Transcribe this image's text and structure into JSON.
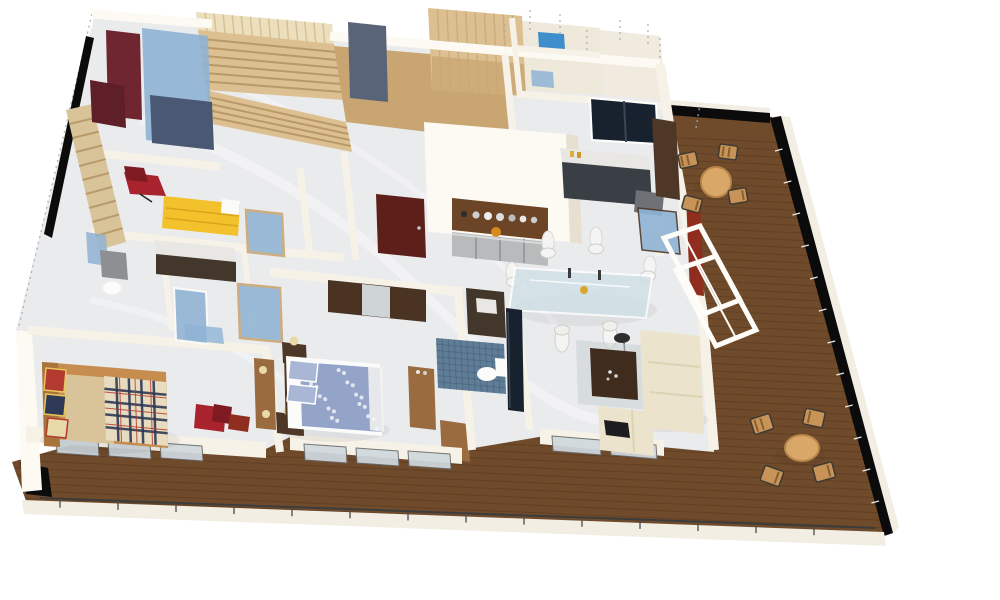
{
  "scene": {
    "type": "3d-floor-plan-render",
    "view": "isometric-cutaway",
    "background": "#ffffff"
  },
  "palette": {
    "wall": "#f7f2e7",
    "wall_bright": "#fdfaf3",
    "wall_shade": "#e7e0d0",
    "black_band": "#0b0b0b",
    "floor_marble": "#eaebed",
    "marble_vein": "#f7f8fa",
    "deck_wood": "#6f4b2b",
    "deck_plank": "#55351d",
    "deck_trim": "#f2eee3",
    "stair_pine": "#dcc091",
    "stair_pine_dark": "#c9a571",
    "slat_wall": "#ecdfbe",
    "slat_line": "#d5bd8e",
    "tread_line": "#b2905e",
    "maroon": "#6f2630",
    "maroon_dark": "#5f1f28",
    "glass_blue": "#8fb3d4",
    "glass_blue_deep": "#3e8ecc",
    "navy_unit": "#4a5874",
    "slate_box": "#5a6478",
    "window_dark": "#18222e",
    "bar_wood": "#6b4526",
    "steel": "#b9babc",
    "steel_dark": "#8e8f92",
    "door_maroon": "#5c1f1a",
    "glass_table": "#cfdfe6",
    "chair_white": "#f4f4f2",
    "sofa_cream": "#ece3cc",
    "sofa_cream_dark": "#ded2b4",
    "coffee_table": "#3f2c1c",
    "red_chair": "#a8232e",
    "red_dark": "#7e1a22",
    "red_jamb": "#8f2d1f",
    "yellow_bed": "#f2c12c",
    "yellow_fold": "#d9a51a",
    "blue_duvet": "#94a3c8",
    "pillow_blue": "#aab6d6",
    "plaid_base": "#e8dcc0",
    "plaid_navy": "#2e3a55",
    "plaid_red": "#b23a2e",
    "bed_wood": "#c68d4e",
    "headboard_wood": "#a9743c",
    "mattress_tan": "#d9c49a",
    "dresser_wood": "#9a6b3f",
    "wardrobe_dark": "#4a3322",
    "mirror_gray": "#cfd4d6",
    "mosaic_blue": "#5f7d96",
    "mosaic_line": "#47617a",
    "vanity_dark": "#43372c",
    "fixture_white": "#fbfbf9",
    "patio_tan": "#d9a869",
    "patio_stripe": "#8a5f33",
    "patio_frame": "#3d3a36",
    "glass_panel": "#cfd9de",
    "door_frame_white": "#fdfcf8",
    "counter_dark": "#3a3f45",
    "counter_top": "#e9e7e3",
    "cabinet_wood": "#4e3726",
    "gray_chair": "#6e7276",
    "lamp_shade": "#e8d9a8",
    "rug_gray": "#c3cdd2",
    "rail_wire": "#4a4a4a"
  },
  "rooms": [
    {
      "id": "staircase"
    },
    {
      "id": "walk-in-closet"
    },
    {
      "id": "upper-bathrooms"
    },
    {
      "id": "study-kitchenette"
    },
    {
      "id": "kitchen-bar"
    },
    {
      "id": "hallway-entry"
    },
    {
      "id": "guest-room-yellow-bed"
    },
    {
      "id": "family-bathroom"
    },
    {
      "id": "bedroom-plaid"
    },
    {
      "id": "master-bedroom"
    },
    {
      "id": "master-bathroom"
    },
    {
      "id": "dining-area"
    },
    {
      "id": "living-room"
    },
    {
      "id": "balcony-deck"
    }
  ],
  "furniture_facts": {
    "patio_sets": 2,
    "patio_chairs_per_set": 4,
    "dining_chairs": 6,
    "beds": 3,
    "bar_plates": 7
  }
}
